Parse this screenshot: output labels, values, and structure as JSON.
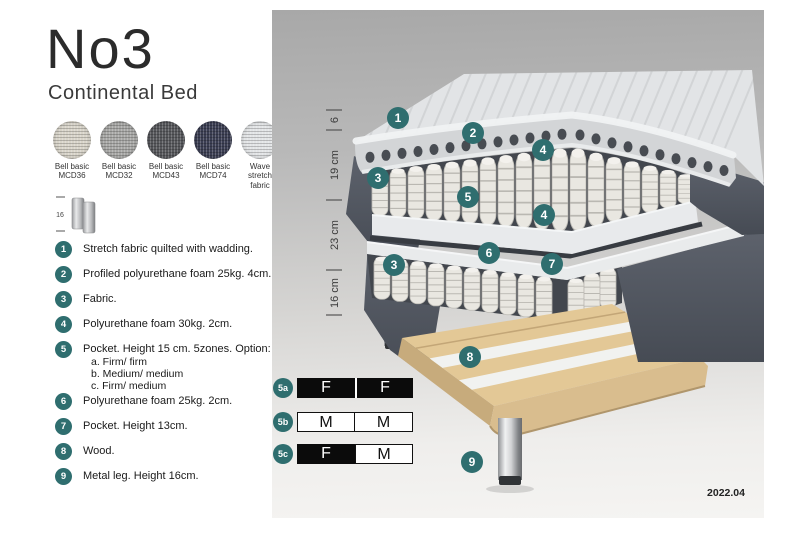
{
  "header": {
    "title": "No3",
    "subtitle": "Continental Bed"
  },
  "swatches": [
    {
      "line1": "Bell basic",
      "line2": "MCD36",
      "color": "#d8d4c9"
    },
    {
      "line1": "Bell basic",
      "line2": "MCD32",
      "color": "#a7a7a5"
    },
    {
      "line1": "Bell basic",
      "line2": "MCD43",
      "color": "#56575b"
    },
    {
      "line1": "Bell basic",
      "line2": "MCD74",
      "color": "#3b3e53"
    },
    {
      "line1": "Wave",
      "line2": "stretch fabric",
      "color": "#e2e4e6"
    }
  ],
  "leg_icon": {
    "height_label": "16"
  },
  "legend": [
    {
      "num": "1",
      "text": "Stretch fabric quilted with wadding."
    },
    {
      "num": "2",
      "text": "Profiled polyurethane foam 25kg. 4cm."
    },
    {
      "num": "3",
      "text": "Fabric."
    },
    {
      "num": "4",
      "text": "Polyurethane foam 30kg. 2cm."
    },
    {
      "num": "5",
      "text": "Pocket. Height 15 cm. 5zones. Option:",
      "options": [
        "a. Firm/ firm",
        "b. Medium/ medium",
        "c. Firm/ medium"
      ]
    },
    {
      "num": "6",
      "text": "Polyurethane foam 25kg. 2cm."
    },
    {
      "num": "7",
      "text": "Pocket. Height 13cm."
    },
    {
      "num": "8",
      "text": "Wood."
    },
    {
      "num": "9",
      "text": "Metal leg. Height 16cm."
    }
  ],
  "diagram": {
    "dimensions": [
      "6",
      "19 cm",
      "23 cm",
      "16 cm"
    ],
    "callouts": [
      "1",
      "2",
      "4",
      "3",
      "5",
      "4",
      "6",
      "3",
      "7",
      "8",
      "9"
    ]
  },
  "firmness": {
    "rows": [
      {
        "label": "5a",
        "cells": [
          "F",
          "F"
        ]
      },
      {
        "label": "5b",
        "cells": [
          "M",
          "M"
        ]
      },
      {
        "label": "5c",
        "cells": [
          "F",
          "M"
        ]
      }
    ]
  },
  "footer": {
    "version": "2022.04"
  },
  "colors": {
    "badge_teal": "#2f6e6f",
    "fabric_dark": "#565b65",
    "wood": "#e2c795",
    "metal": "#c9cacc"
  }
}
